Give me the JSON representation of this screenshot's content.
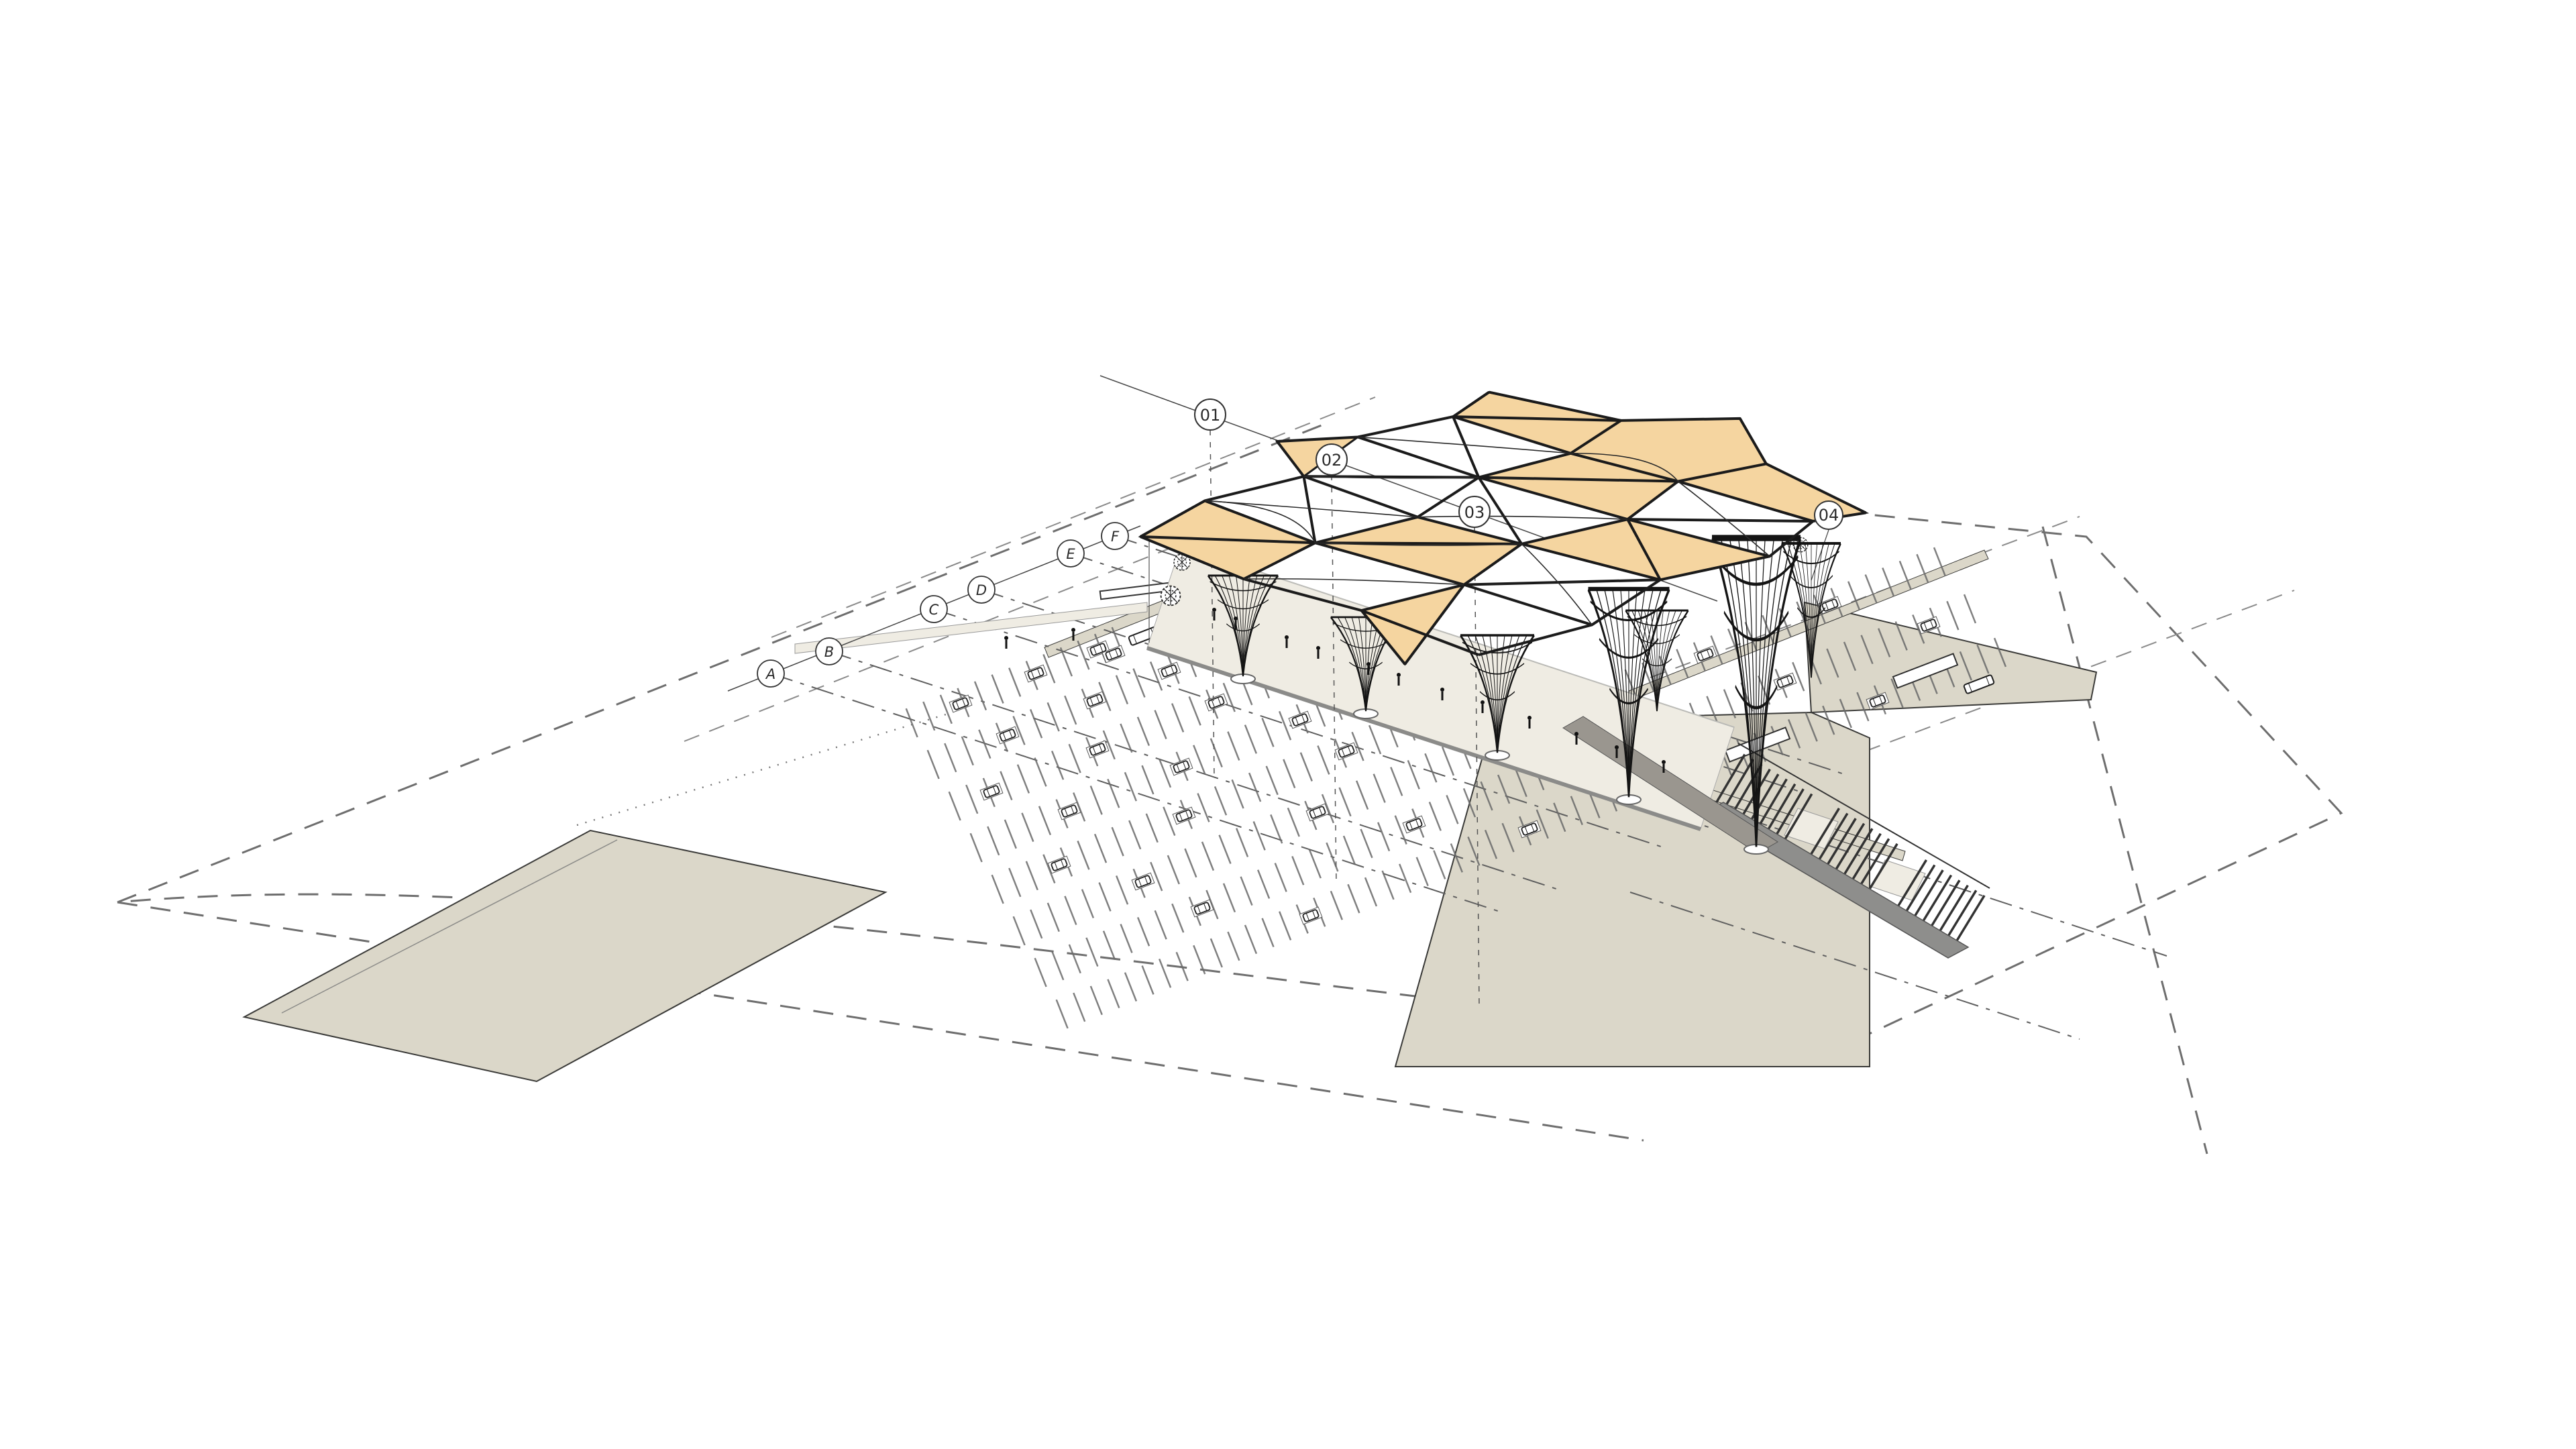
{
  "drawing": {
    "background": "#ffffff",
    "colors": {
      "canopy_panel": "#F5D5A0",
      "canopy_line": "#1B1B1B",
      "ground_fill": "#DBD7C9",
      "platform_fill": "#EFECE3",
      "stair_side": "#8E8E8C",
      "ramp_fill": "#9A968F",
      "boundary_dash": "#6E6E6E",
      "plan_line": "#3A3A38",
      "centerline": "#5F5F5F",
      "pad_stroke": "#666666"
    },
    "grid_markers": {
      "top": [
        {
          "label": "01"
        },
        {
          "label": "02"
        },
        {
          "label": "03"
        },
        {
          "label": "04"
        }
      ],
      "side": [
        {
          "label": "A"
        },
        {
          "label": "B"
        },
        {
          "label": "C"
        },
        {
          "label": "D"
        },
        {
          "label": "E"
        },
        {
          "label": "F"
        }
      ]
    }
  }
}
